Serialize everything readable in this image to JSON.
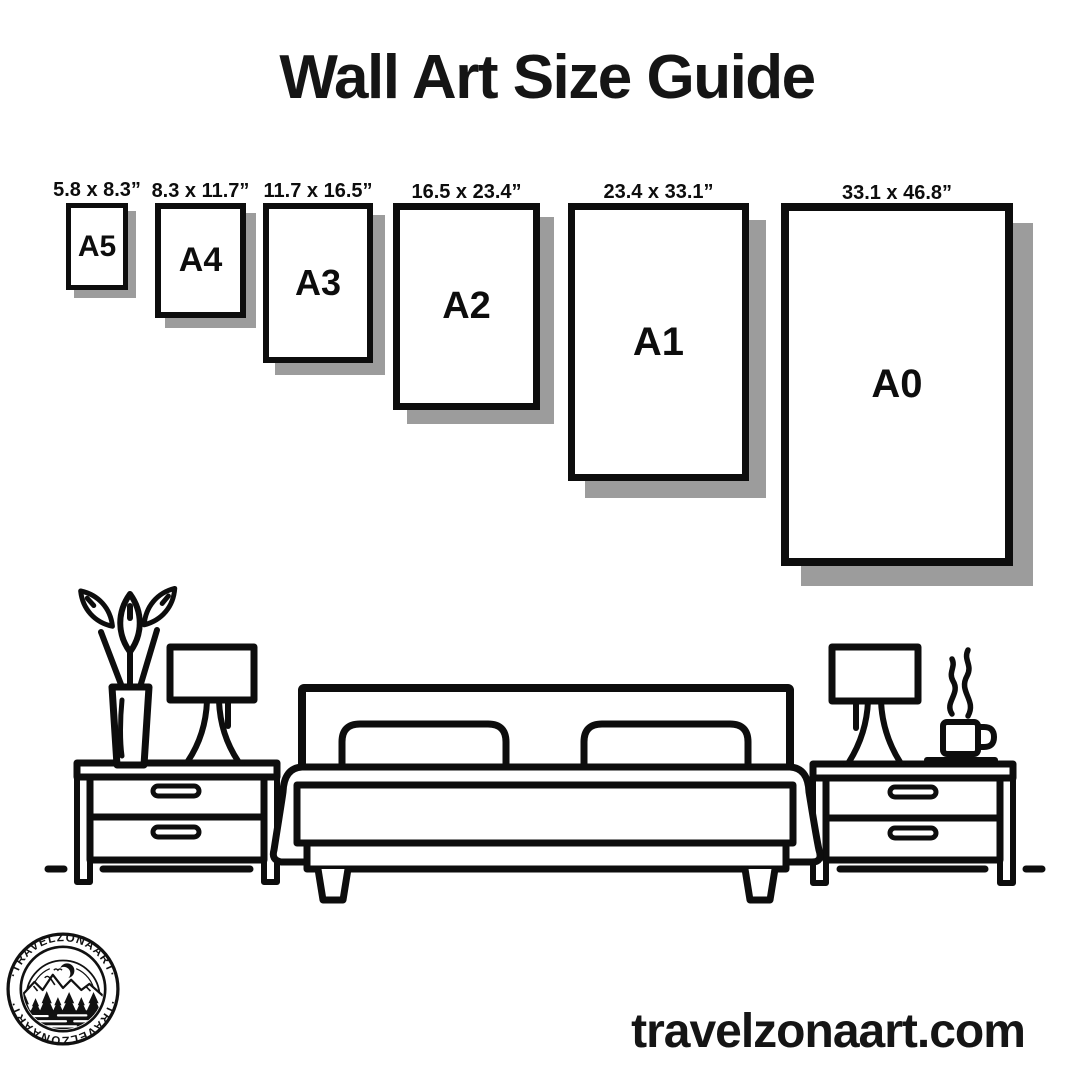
{
  "title": "Wall Art Size Guide",
  "frames": [
    {
      "name": "A5",
      "size_label": "5.8 x 8.3”"
    },
    {
      "name": "A4",
      "size_label": "8.3 x 11.7”"
    },
    {
      "name": "A3",
      "size_label": "11.7 x 16.5”"
    },
    {
      "name": "A2",
      "size_label": "16.5 x 23.4”"
    },
    {
      "name": "A1",
      "size_label": "23.4 x 33.1”"
    },
    {
      "name": "A0",
      "size_label": "33.1 x 46.8”"
    }
  ],
  "logo": {
    "arc_text_top": "·TRAVELZONAART·",
    "arc_text_bottom": "·TRAVELZONAART·"
  },
  "footer": {
    "website": "travelzonaart.com"
  },
  "colors": {
    "ink": "#0d0d0d",
    "frame_shadow": "#9c9c9c",
    "background": "#ffffff"
  }
}
